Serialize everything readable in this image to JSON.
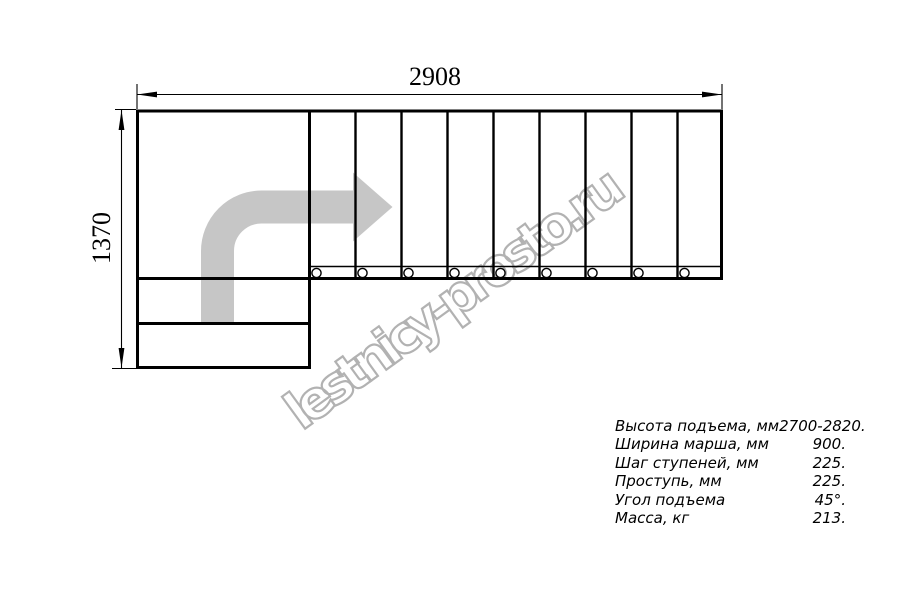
{
  "dimensions": {
    "width_label": "2908",
    "height_label": "1370"
  },
  "watermark": {
    "text": "lestnicy-prosto.ru"
  },
  "specs": {
    "rows": [
      {
        "label": "Высота подъема, мм",
        "value": "2700-2820."
      },
      {
        "label": "Ширина марша, мм",
        "value": "900."
      },
      {
        "label": "Шаг ступеней, мм",
        "value": "225."
      },
      {
        "label": "Проступь, мм",
        "value": "225."
      },
      {
        "label": "Угол подъема",
        "value": "45°."
      },
      {
        "label": "Масса, кг",
        "value": "213."
      }
    ]
  },
  "colors": {
    "line": "#000000",
    "arrow": "#c6c6c6",
    "watermark_outline": "#b2b2b2"
  }
}
